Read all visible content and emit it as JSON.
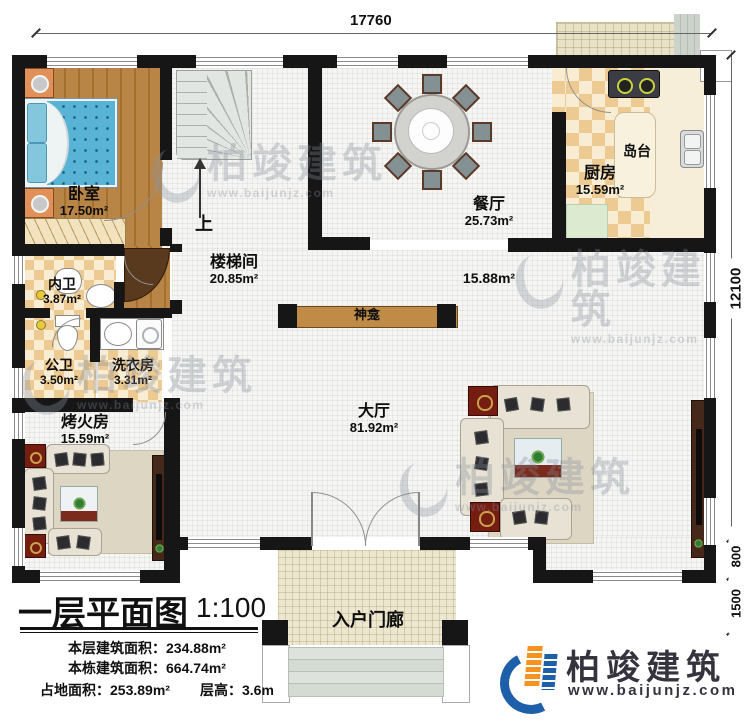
{
  "dimensions": {
    "top_width": "17760",
    "right_main": "12100",
    "right_step": "800",
    "right_porch": "1500"
  },
  "rooms": {
    "bedroom": {
      "name": "卧室",
      "area": "17.50m²"
    },
    "stairwell": {
      "name": "楼梯间",
      "area": "20.85m²"
    },
    "dining": {
      "name": "餐厅",
      "area": "25.73m²"
    },
    "kitchen": {
      "name": "厨房",
      "area": "15.59m²"
    },
    "island": {
      "name": "岛台"
    },
    "inner_bath": {
      "name": "内卫",
      "area": "3.87m²"
    },
    "public_bath": {
      "name": "公卫",
      "area": "3.50m²"
    },
    "laundry": {
      "name": "洗衣房",
      "area": "3.31m²"
    },
    "fire_room": {
      "name": "烤火房",
      "area": "15.59m²"
    },
    "hall": {
      "name": "大厅",
      "area": "81.92m²"
    },
    "hall_sub_area": "15.88m²",
    "shrine": {
      "name": "神龛"
    },
    "porch": {
      "name": "入户门廊"
    }
  },
  "stairs": {
    "up_label": "上"
  },
  "title_block": {
    "title": "一层平面图",
    "scale": "1:100",
    "line1": "本层建筑面积：234.88m²",
    "line2": "本栋建筑面积：664.74m²",
    "line3a": "占地面积：253.89m²",
    "line3b": "层高：3.6m"
  },
  "watermark": {
    "brand": "柏竣建筑",
    "url": "www.baijunjz.com"
  },
  "logo": {
    "brand": "柏竣建筑",
    "url": "www.baijunjz.com",
    "blue": "#1d5fa8",
    "orange": "#f6921e",
    "text_color": "#34333e"
  }
}
